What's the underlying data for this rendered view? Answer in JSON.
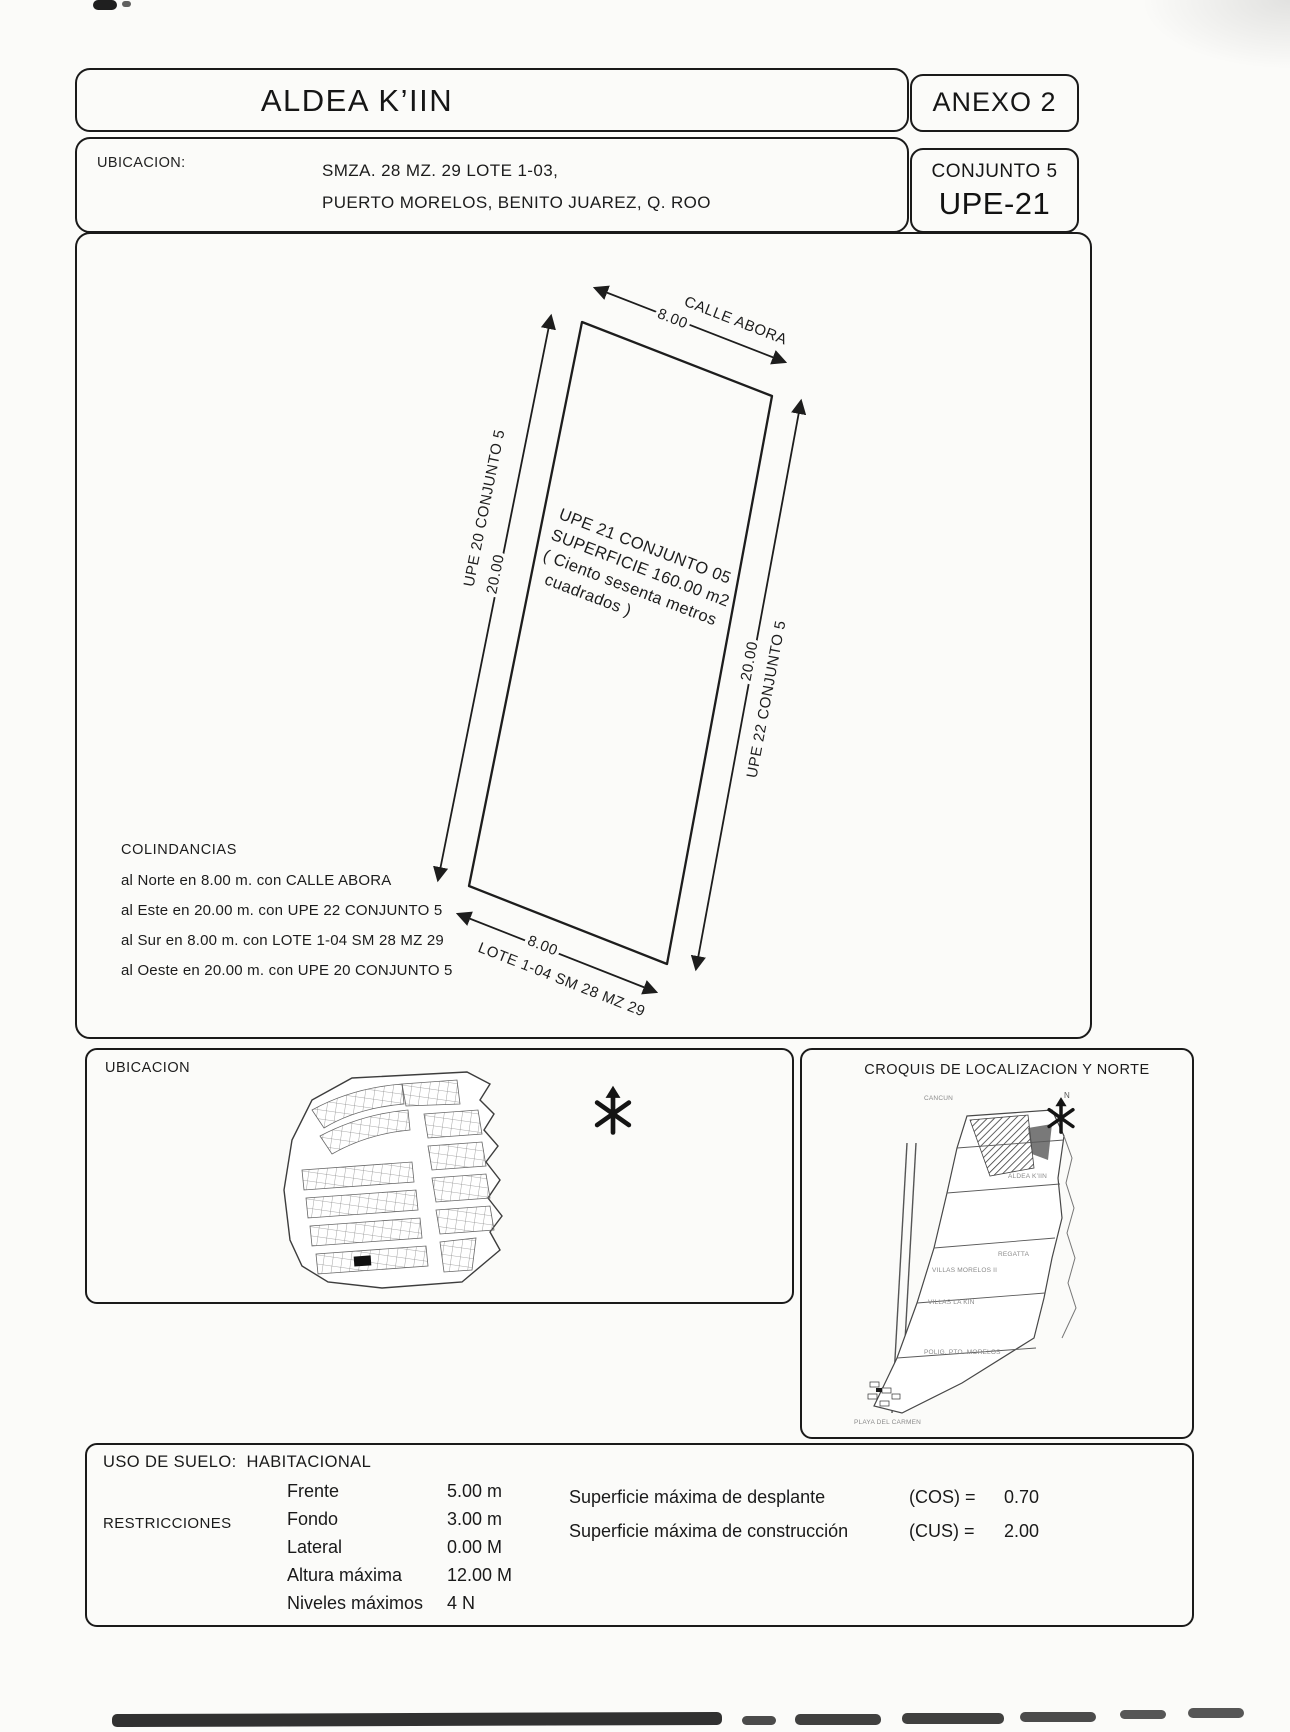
{
  "header": {
    "title": "ALDEA K’IIN",
    "annex": "ANEXO 2",
    "location_label": "UBICACION:",
    "location_line1": "SMZA. 28 MZ. 29 LOTE 1-03,",
    "location_line2": "PUERTO MORELOS, BENITO JUAREZ, Q. ROO",
    "conjunto": "CONJUNTO 5",
    "upe": "UPE-21"
  },
  "site_plan": {
    "north_street": {
      "name": "CALLE ABORA",
      "dim": "8.00"
    },
    "west": {
      "name": "UPE 20 CONJUNTO 5",
      "dim": "20.00"
    },
    "east": {
      "name": "UPE 22 CONJUNTO 5",
      "dim": "20.00"
    },
    "south": {
      "name": "LOTE 1-04 SM 28 MZ 29",
      "dim": "8.00"
    },
    "parcel": {
      "line1": "UPE 21 CONJUNTO 05",
      "line2": "SUPERFICIE 160.00 m2",
      "line3": "( Ciento sesenta metros",
      "line4": "cuadrados )"
    },
    "colindancias": {
      "heading": "COLINDANCIAS",
      "items": [
        "al Norte en 8.00 m. con CALLE ABORA",
        "al Este en 20.00 m. con UPE 22 CONJUNTO 5",
        "al Sur en 8.00 m. con LOTE 1-04 SM 28 MZ 29",
        "al Oeste en 20.00 m. con UPE 20 CONJUNTO 5"
      ]
    }
  },
  "location_map": {
    "title": "UBICACION"
  },
  "croquis": {
    "title": "CROQUIS DE LOCALIZACION Y NORTE",
    "north_letter": "N",
    "labels": [
      "CANCUN",
      "ALDEA K’IIN",
      "REGATTA",
      "VILLAS MORELOS II",
      "VILLAS LA KIN",
      "POLIG. PTO. MORELOS",
      "PLAYA DEL CARMEN"
    ]
  },
  "zoning": {
    "land_use_label": "USO DE SUELO:",
    "land_use_value": "HABITACIONAL",
    "restrictions_label": "RESTRICCIONES",
    "rows": [
      {
        "label": "Frente",
        "value": "5.00 m"
      },
      {
        "label": "Fondo",
        "value": "3.00 m"
      },
      {
        "label": "Lateral",
        "value": "0.00 M"
      },
      {
        "label": "Altura máxima",
        "value": "12.00 M"
      },
      {
        "label": "Niveles máximos",
        "value": "4 N"
      }
    ],
    "coefficients": [
      {
        "label": "Superficie máxima de desplante",
        "key": "(COS) =",
        "value": "0.70"
      },
      {
        "label": "Superficie máxima de construcción",
        "key": "(CUS) =",
        "value": "2.00"
      }
    ]
  }
}
